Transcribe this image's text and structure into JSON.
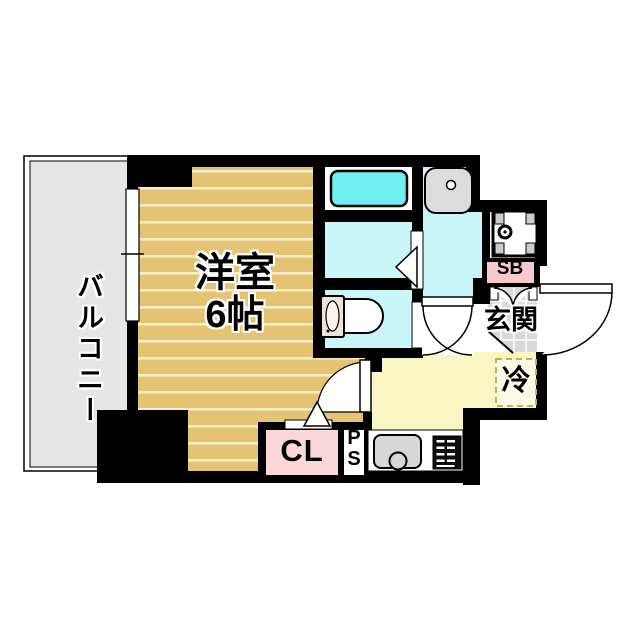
{
  "floorplan": {
    "type": "japanese-apartment-floor-plan",
    "labels": {
      "balcony": "バルコニー",
      "room": "洋室",
      "room_size": "6帖",
      "entrance": "玄関",
      "shoebox": "SB",
      "refrigerator": "冷",
      "closet": "CL",
      "pipe_space": [
        "P",
        "S"
      ]
    },
    "colors": {
      "wall": "#000000",
      "flooring": "#e4c473",
      "flooring_stripe": "#f6edca",
      "kitchen_floor": "#f9f6c3",
      "wet_area": "#c9f7f9",
      "bathtub": "#6fefef",
      "closet_pink": "#f9d7da",
      "shoebox_pink": "#f6c9ce",
      "entrance_tile": "#d9d9d9",
      "balcony_gray": "#e6e6e6",
      "fixture_gray": "#d7d7d7",
      "refrigerator_dash": "#c4ad55"
    }
  }
}
